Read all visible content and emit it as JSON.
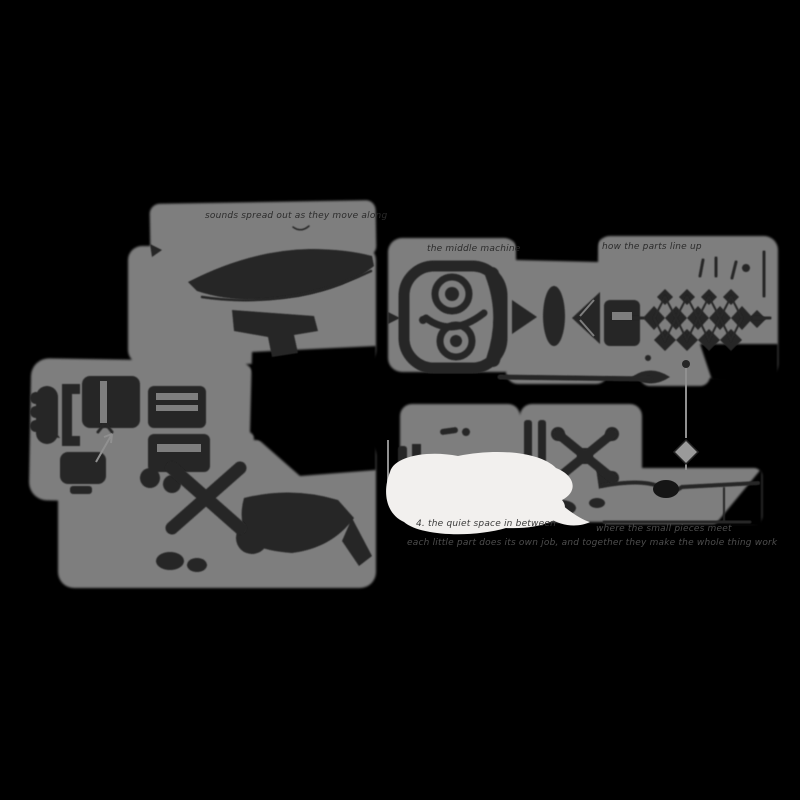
{
  "colors": {
    "background": "#000000",
    "paper_wash": "#7e7e7e",
    "ink": "#262626",
    "ink_soft": "#2b2b2b",
    "white_patch": "#f2f0ee",
    "caption_text": "#4e4e4e",
    "faint_gray_line": "#909090",
    "diamond_gray": "#9a9a9a",
    "notch_dark": "#151515"
  },
  "labels": {
    "left_page_note": "sounds spread out as they move along",
    "machine_note": "the middle machine",
    "lattice_note": "how the parts line up",
    "white_patch_note": "4. the quiet space in between",
    "caption_line_1": "where the small pieces meet",
    "caption_line_2": "each little part does its own job, and together they make the whole thing work"
  },
  "sketches": [
    "curved-horn-ribbon",
    "hooked-bar",
    "stacked-rollers",
    "clamp-bracket",
    "slotted-box",
    "small-box",
    "cross-x-mark",
    "lower-ribbon",
    "round-gear-machine",
    "pointer-triangle",
    "lens",
    "cone-funnel",
    "crystal-lattice",
    "sprigs",
    "eye-shape",
    "plumb-line-diamond",
    "ground-slab-with-notch",
    "bowtie-cross",
    "twin-bars",
    "ink-dots"
  ]
}
